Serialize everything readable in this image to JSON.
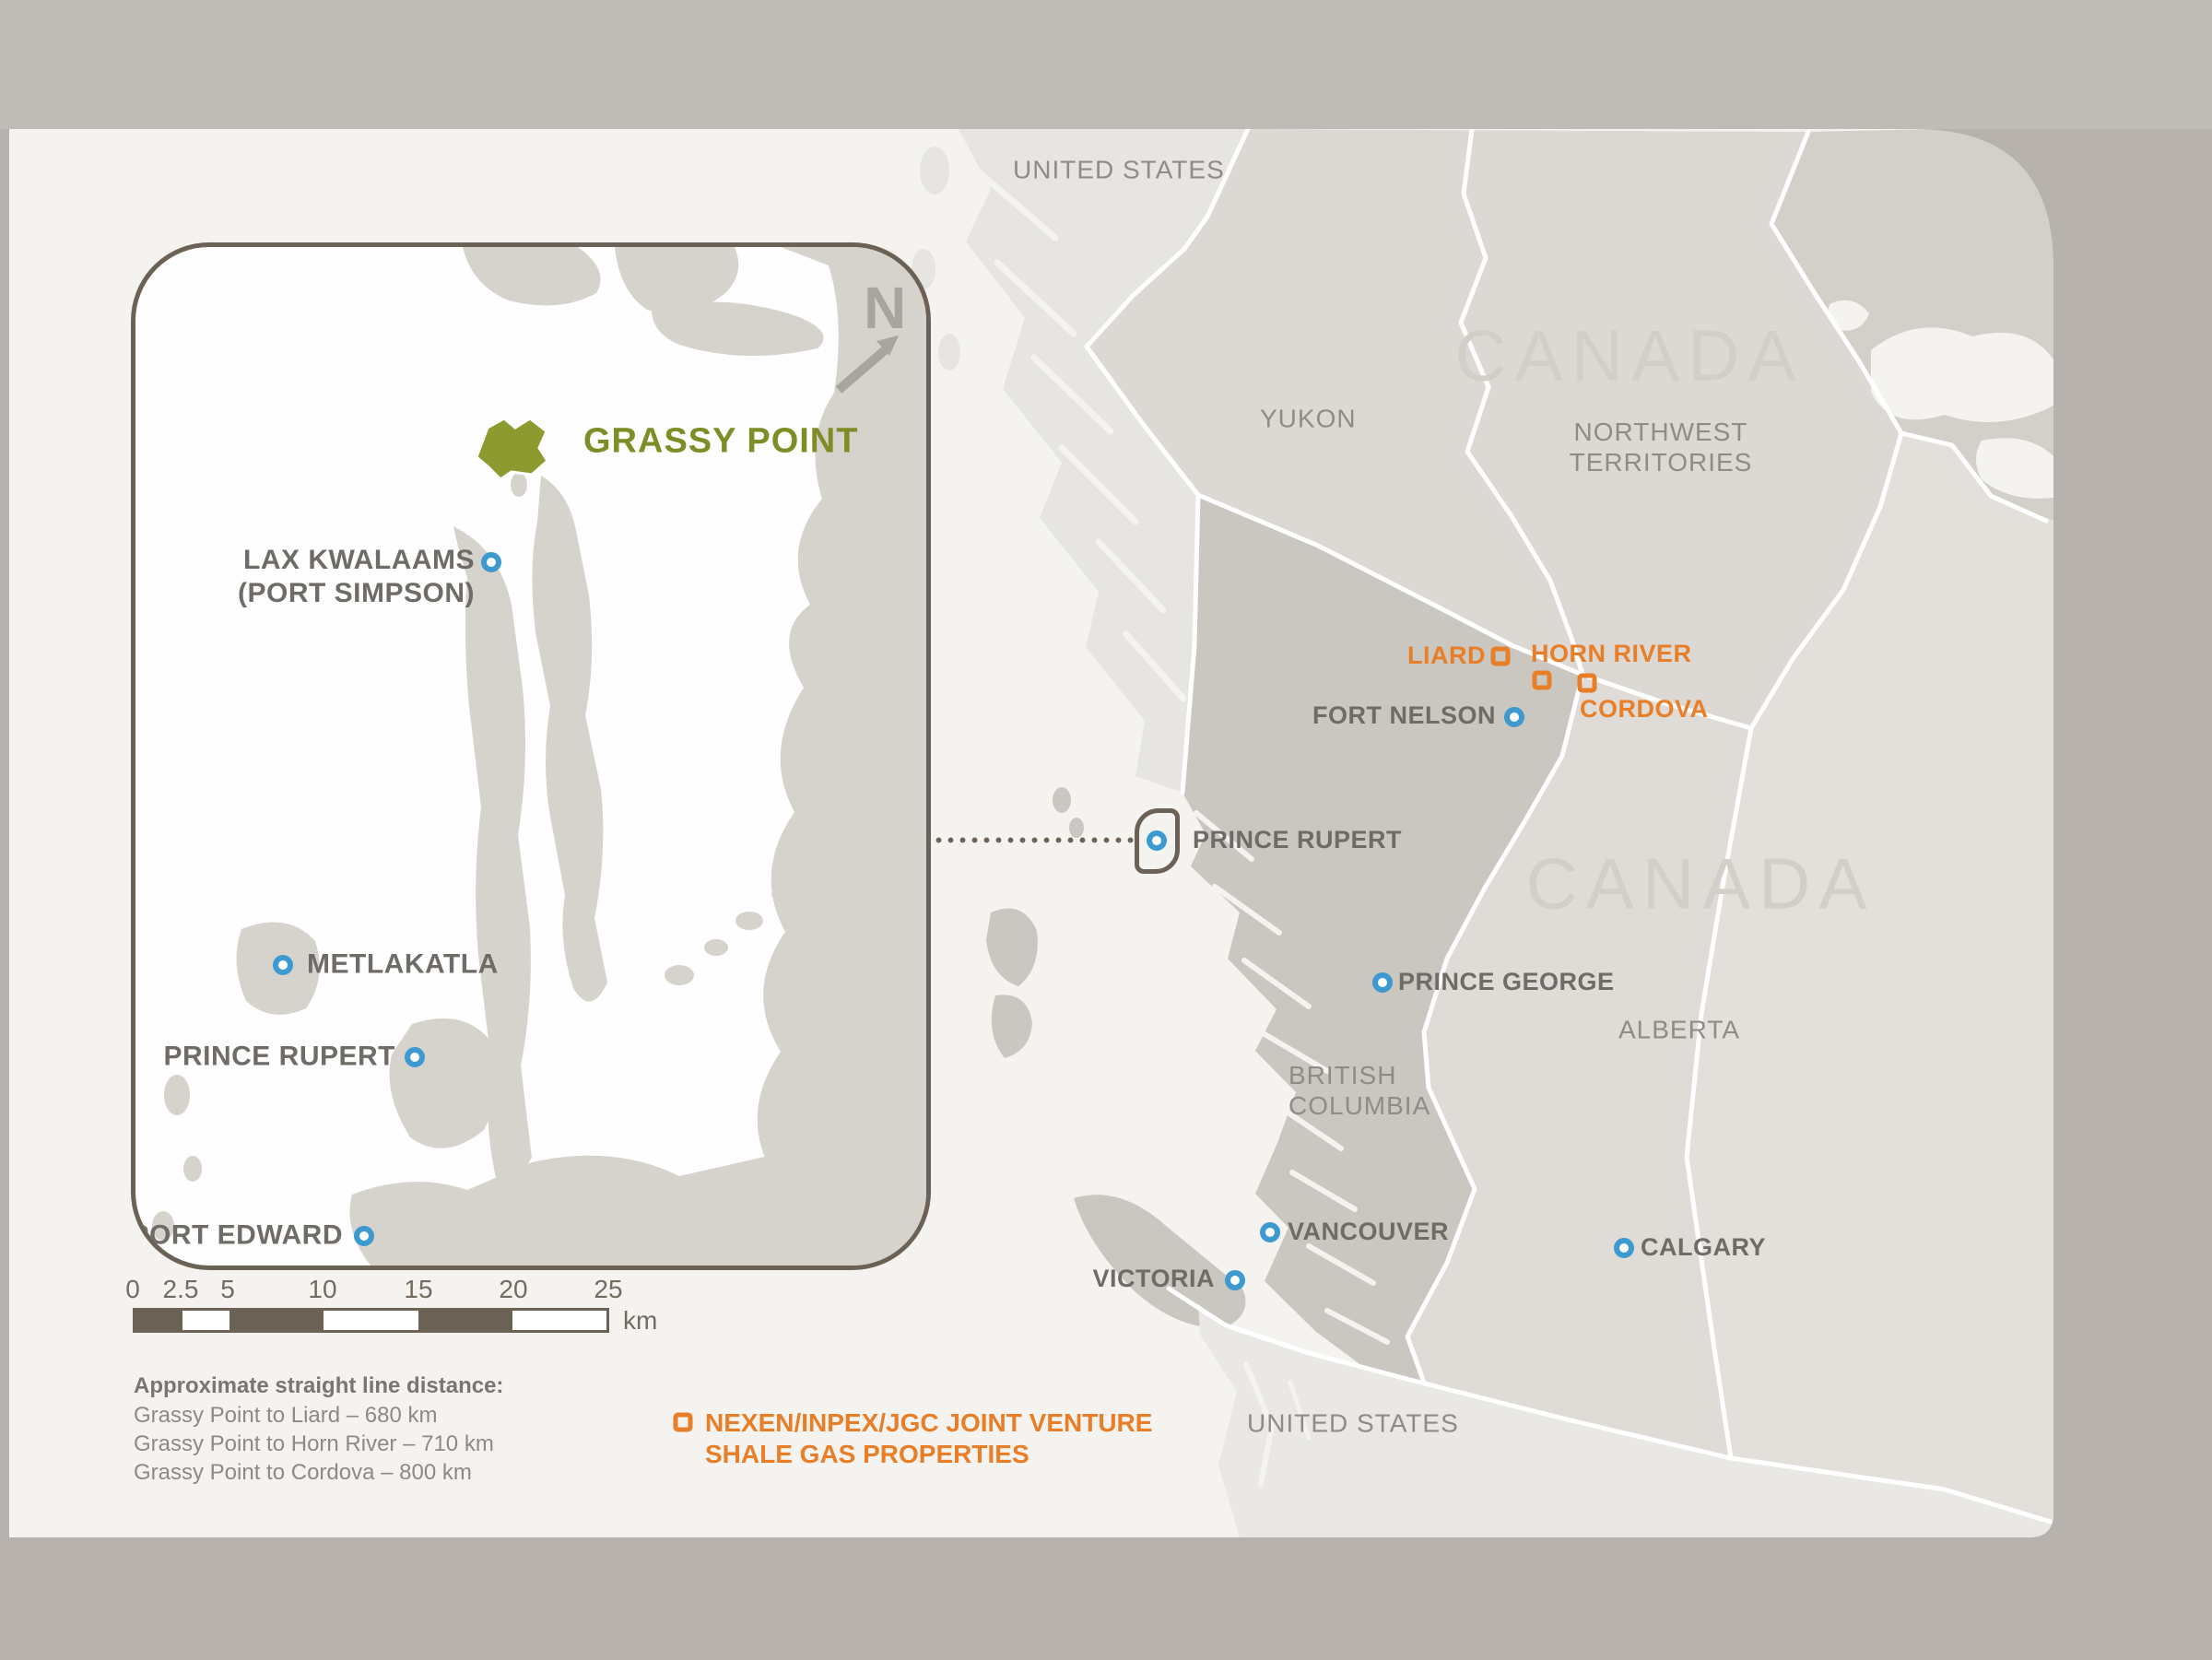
{
  "inset": {
    "site_label": "GRASSY POINT",
    "compass": "N",
    "cities": [
      {
        "name": "LAX KWALAAMS",
        "name2": "(PORT SIMPSON)"
      },
      {
        "name": "METLAKATLA"
      },
      {
        "name": "PRINCE RUPERT"
      },
      {
        "name": "PORT EDWARD"
      }
    ],
    "scale": {
      "ticks": [
        "0",
        "2.5",
        "5",
        "10",
        "15",
        "20",
        "25"
      ],
      "unit": "km"
    }
  },
  "main_map": {
    "regions": {
      "canada": "CANADA",
      "us_top": "UNITED STATES",
      "yukon": "YUKON",
      "nwt_line1": "NORTHWEST",
      "nwt_line2": "TERRITORIES",
      "bc_line1": "BRITISH",
      "bc_line2": "COLUMBIA",
      "alberta": "ALBERTA",
      "us_bottom": "UNITED STATES"
    },
    "cities": {
      "fort_nelson": "FORT NELSON",
      "prince_rupert": "PRINCE RUPERT",
      "prince_george": "PRINCE GEORGE",
      "vancouver": "VANCOUVER",
      "victoria": "VICTORIA",
      "calgary": "CALGARY"
    },
    "shale_sites": {
      "liard": "LIARD",
      "horn_river": "HORN RIVER",
      "cordova": "CORDOVA"
    }
  },
  "notes": {
    "title": "Approximate straight line distance:",
    "lines": [
      "Grassy Point to Liard – 680 km",
      "Grassy Point to Horn River – 710 km",
      "Grassy Point to Cordova – 800 km"
    ]
  },
  "legend": {
    "line1": "NEXEN/INPEX/JGC JOINT VENTURE",
    "line2": "SHALE GAS PROPERTIES"
  },
  "colors": {
    "accent_orange": "#e87e27",
    "marker_blue": "#3d9ad1",
    "site_olive": "#8d9a2f",
    "frame_brown": "#6b6154"
  }
}
